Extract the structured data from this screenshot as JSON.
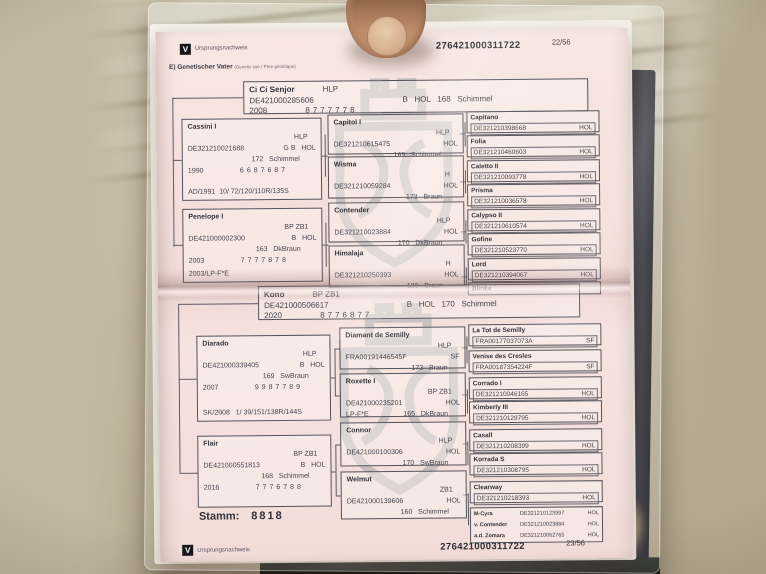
{
  "colors": {
    "page": "#f3ded9",
    "watermark": "#8f9398",
    "ink": "#46444d",
    "logo_black": "#17161a"
  },
  "page_top": {
    "header": {
      "logo_letter": "V",
      "brand": "Ursprungsnachweis",
      "number": "276421000311722",
      "page": "22/56"
    },
    "section": {
      "label": "E) Genetischer Vater",
      "note": "(Genetic sire / Père génétique)"
    },
    "root": {
      "name": "Ci Ci Senjor",
      "tag": "HLP",
      "id": "DE421000285606",
      "sbhc": "B   HOL   168   Schimmel",
      "yr": "2008",
      "sc": "8777778"
    },
    "gen1": [
      {
        "name": "Cassini I",
        "tag": "HLP",
        "id": "DE321210021688",
        "sb": "G B   HOL",
        "hc": "172   Schimmel",
        "yr": "1990",
        "sc": "6687687",
        "ex": "AD/1991  10/ 72/120/110R/135S"
      },
      {
        "name": "Penelope I",
        "tag": "BP ZB1",
        "id": "DE421000002300",
        "sb": "B   HOL",
        "hc": "163   DkBraun",
        "yr": "2003",
        "sc": "7777878",
        "ex": "2003/LP-F*E"
      }
    ],
    "gen2": [
      {
        "name": "Capitol I",
        "tag": "HLP",
        "id": "DE321210615475",
        "sb": "HOL",
        "pre": "",
        "hc": "169   Schimmel"
      },
      {
        "name": "Wisma",
        "tag": "H",
        "id": "DE321210059284",
        "sb": "HOL",
        "pre": "",
        "hc": "173   Braun"
      },
      {
        "name": "Contender",
        "tag": "HLP",
        "id": "DE321210023884",
        "sb": "HOL",
        "pre": "",
        "hc": "170   DkBraun"
      },
      {
        "name": "Himalaja",
        "tag": "H",
        "id": "DE321210250393",
        "sb": "HOL",
        "pre": "",
        "hc": "180   Braun"
      }
    ],
    "gen3": [
      {
        "name": "Capitano",
        "id": "DE321210398668",
        "reg": "HOL"
      },
      {
        "name": "Folia",
        "id": "DE321210460603",
        "reg": "HOL"
      },
      {
        "name": "Caletto II",
        "id": "DE321210093778",
        "reg": "HOL"
      },
      {
        "name": "Prisma",
        "id": "DE321210036578",
        "reg": "HOL"
      },
      {
        "name": "Calypso II",
        "id": "DE321210610574",
        "reg": "HOL"
      },
      {
        "name": "Gofine",
        "id": "DE321210523770",
        "reg": "HOL"
      },
      {
        "name": "Lord",
        "id": "DE321210394067",
        "reg": "HOL"
      },
      {
        "name": "Blinka",
        "id": "",
        "reg": ""
      }
    ]
  },
  "page_bottom": {
    "root": {
      "name": "Kono",
      "tag": "BP ZB1",
      "id": "DE421000506617",
      "sbhc": "B   HOL   170   Schimmel",
      "yr": "2020",
      "sc": "8776877"
    },
    "gen1": [
      {
        "name": "Diarado",
        "tag": "HLP",
        "id": "DE421000339405",
        "sb": "B   HOL",
        "hc": "169   SwBraun",
        "yr": "2007",
        "sc": "9987789",
        "ex": "SK/2008   1/ 39/151/138R/144S"
      },
      {
        "name": "Flair",
        "tag": "BP ZB1",
        "id": "DE421000551813",
        "sb": "B   HOL",
        "hc": "168   Schimmel",
        "yr": "2016",
        "sc": "7776788",
        "ex": ""
      }
    ],
    "gen2": [
      {
        "name": "Diamant de Semilly",
        "tag": "HLP",
        "id": "FRA00191446545F",
        "sb": "SF",
        "pre": "",
        "hc": "173   Braun"
      },
      {
        "name": "Roxette I",
        "tag": "BP ZB1",
        "id": "DE421000235201",
        "sb": "HOL",
        "pre": "LP-F*E",
        "hc": "165   DkBraun"
      },
      {
        "name": "Connor",
        "tag": "HLP",
        "id": "DE421000100306",
        "sb": "HOL",
        "pre": "",
        "hc": "170   SwBraun"
      },
      {
        "name": "Welmut",
        "tag": "ZB1",
        "id": "DE421000139606",
        "sb": "HOL",
        "pre": "",
        "hc": "160   Schimmel"
      }
    ],
    "gen3": [
      {
        "name": "La Tot de Semilly",
        "id": "FRA00177037073A",
        "reg": "SF"
      },
      {
        "name": "Venise des Cresles",
        "id": "FRA00187354224F",
        "reg": "SF"
      },
      {
        "name": "Corrado I",
        "id": "DE321210046165",
        "reg": "HOL"
      },
      {
        "name": "Kimberly III",
        "id": "DE321210129795",
        "reg": "HOL"
      },
      {
        "name": "Casall",
        "id": "DE321210208399",
        "reg": "HOL"
      },
      {
        "name": "Korrada S",
        "id": "DE321210308795",
        "reg": "HOL"
      },
      {
        "name": "Clearway",
        "id": "DE321210218393",
        "reg": "HOL"
      }
    ],
    "dam_detail": [
      {
        "l": "M-Cyra",
        "id": "DE321210123997",
        "reg": "HOL"
      },
      {
        "l": "v. Contender",
        "id": "DE321210023884",
        "reg": "HOL"
      },
      {
        "l": "a.d. Zomara",
        "id": "DE321210062765",
        "reg": "HOL"
      }
    ],
    "stamm": {
      "label": "Stamm:",
      "value": "8818"
    },
    "footer": {
      "logo_letter": "V",
      "brand": "Ursprungsnachweis",
      "number": "276421000311722",
      "page": "23/56"
    }
  }
}
